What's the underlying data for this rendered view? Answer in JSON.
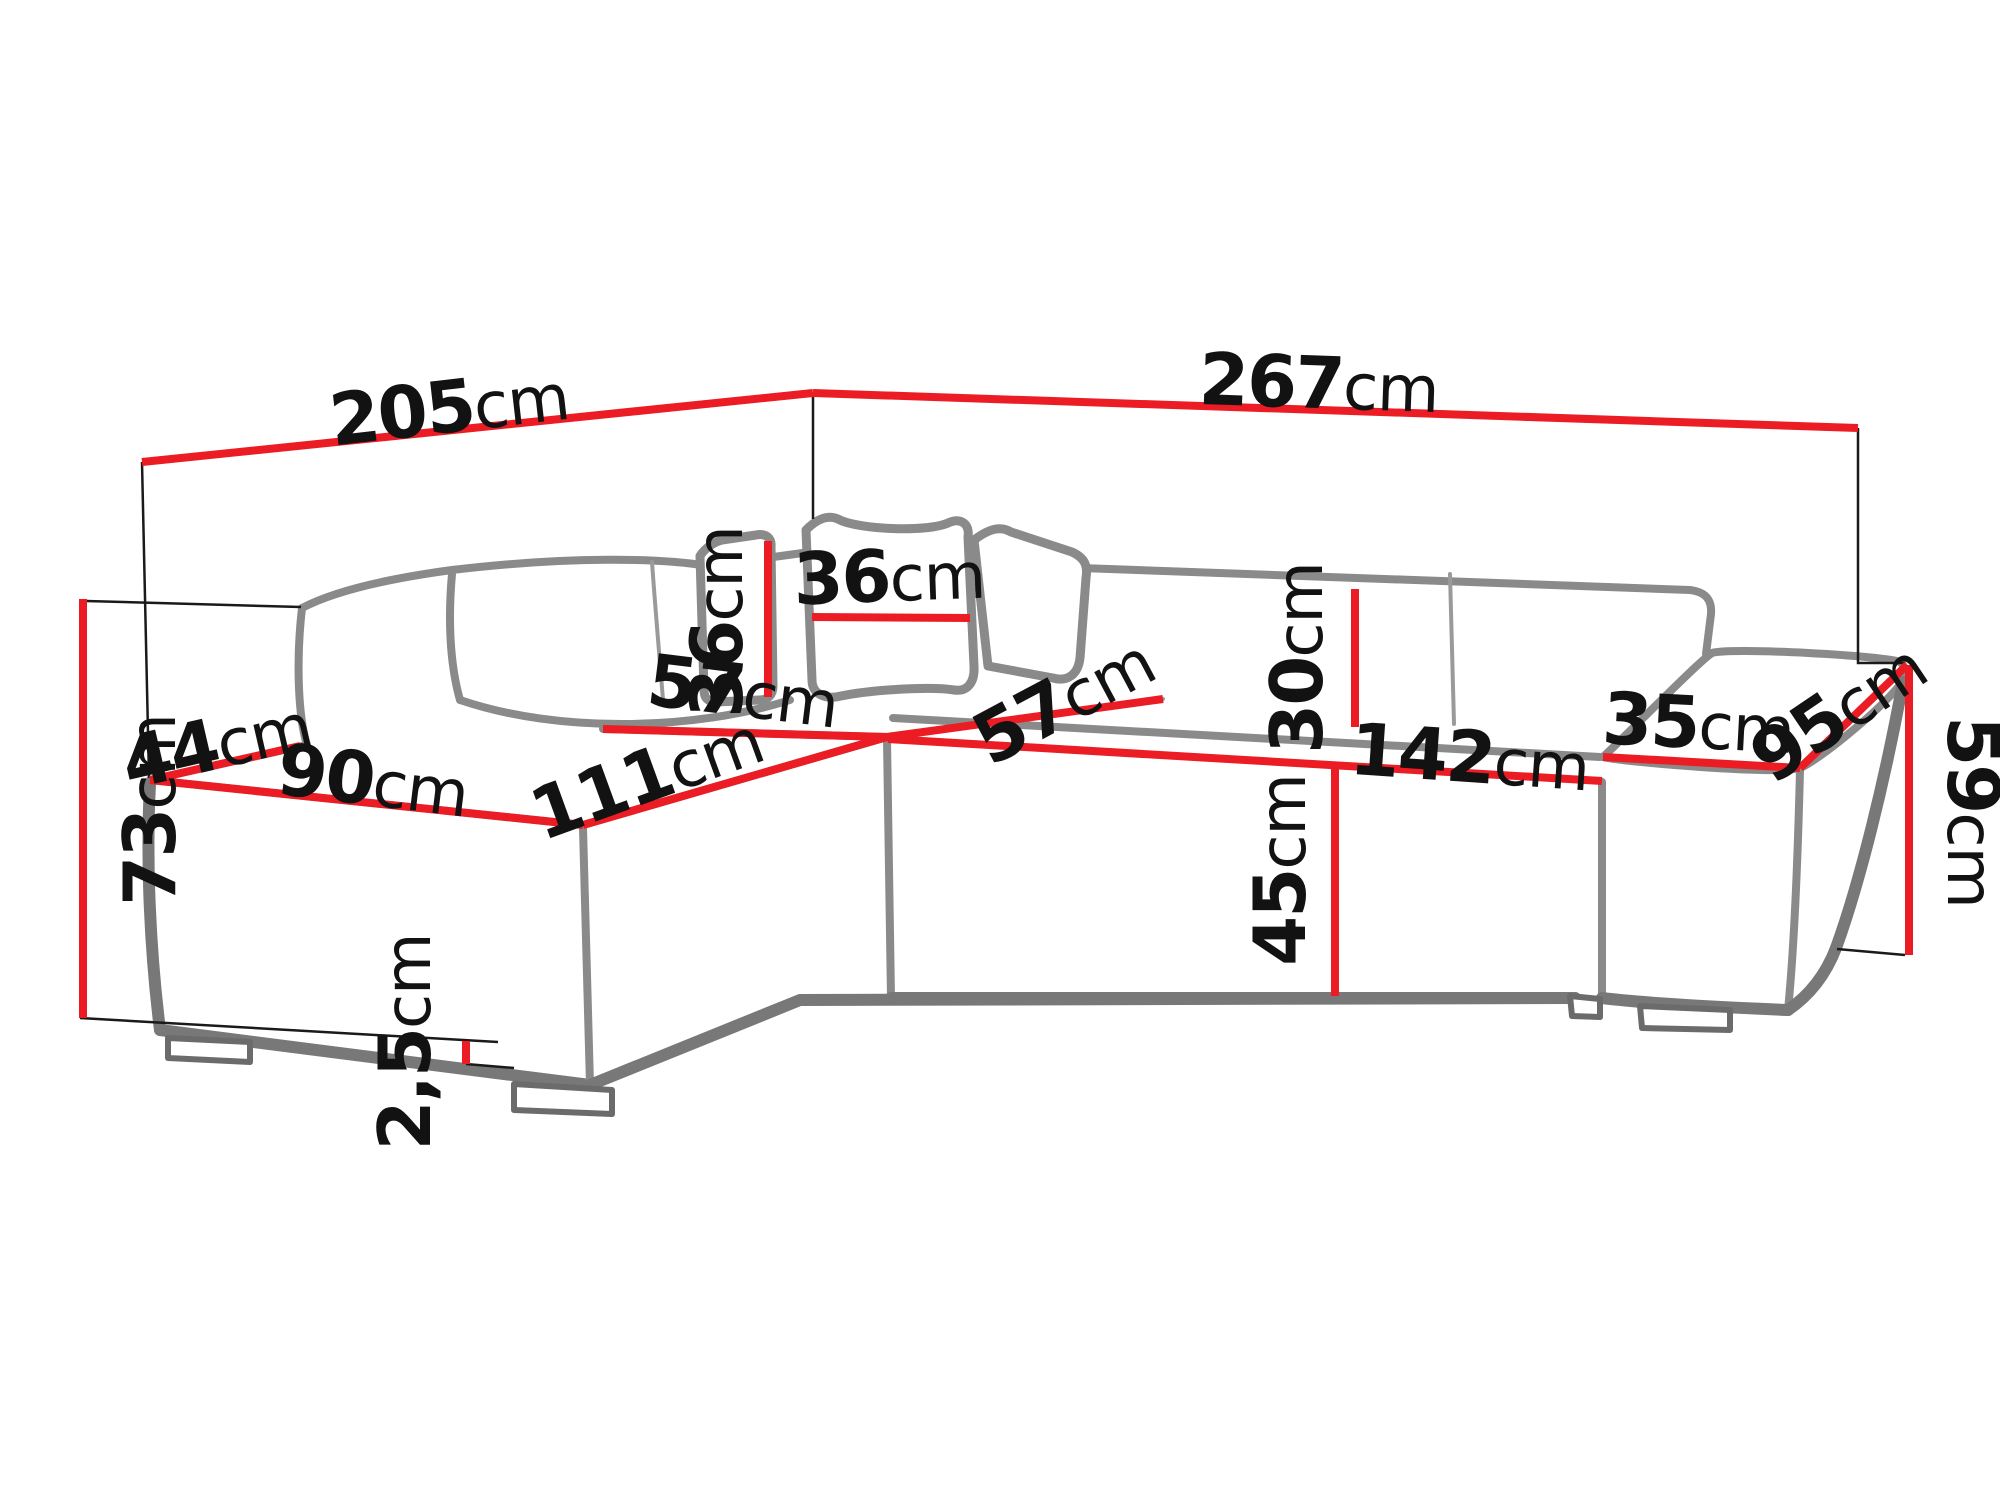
{
  "diagram": {
    "title": "Corner sofa dimension drawing",
    "unit": "cm",
    "accent_color": "#ec1c24",
    "outline_color": "#8a8a8a",
    "label_color": "#121212",
    "dimensions": [
      {
        "id": "total-width-left",
        "value": "205",
        "unit": "cm"
      },
      {
        "id": "total-width-right",
        "value": "267",
        "unit": "cm"
      },
      {
        "id": "total-height",
        "value": "73",
        "unit": "cm"
      },
      {
        "id": "left-end-depth",
        "value": "44",
        "unit": "cm"
      },
      {
        "id": "chaise-seat-width",
        "value": "90",
        "unit": "cm"
      },
      {
        "id": "chaise-seat-length",
        "value": "111",
        "unit": "cm"
      },
      {
        "id": "chaise-seat-depth",
        "value": "57",
        "unit": "cm"
      },
      {
        "id": "pillow-height",
        "value": "36",
        "unit": "cm"
      },
      {
        "id": "pillow-width",
        "value": "36",
        "unit": "cm"
      },
      {
        "id": "backrest-cushion-height",
        "value": "30",
        "unit": "cm"
      },
      {
        "id": "seat-width",
        "value": "142",
        "unit": "cm"
      },
      {
        "id": "seat-depth",
        "value": "57",
        "unit": "cm"
      },
      {
        "id": "seat-height",
        "value": "45",
        "unit": "cm"
      },
      {
        "id": "armrest-width",
        "value": "35",
        "unit": "cm"
      },
      {
        "id": "armrest-depth",
        "value": "95",
        "unit": "cm"
      },
      {
        "id": "armrest-height",
        "value": "59",
        "unit": "cm"
      },
      {
        "id": "foot-height",
        "value": "2,5",
        "unit": "cm"
      }
    ]
  }
}
